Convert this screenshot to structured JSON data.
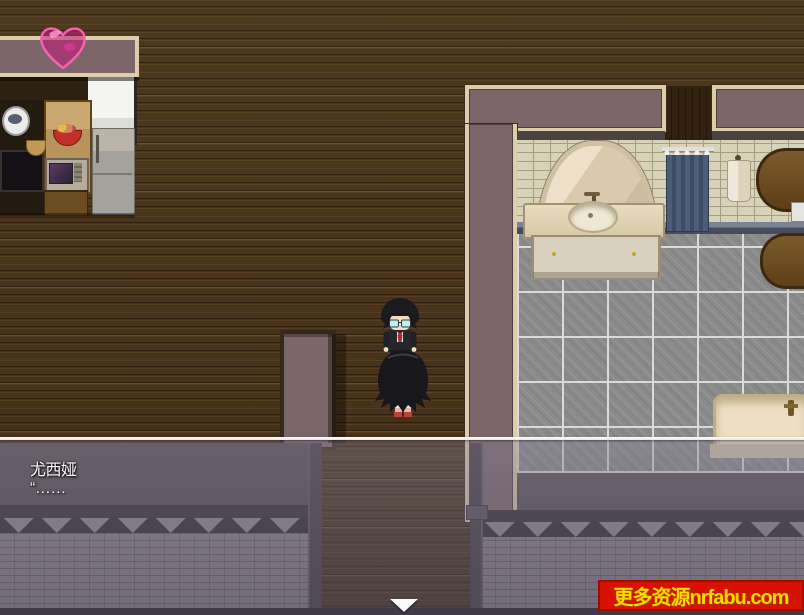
{
  "window": {
    "width": 804,
    "height": 615
  },
  "hud": {
    "heart_icon": "affection-heart-icon",
    "heart_color": "#f463b0"
  },
  "dialogue": {
    "speaker": "尤西娅",
    "line": "“……",
    "continue_icon": "down-triangle-icon"
  },
  "watermark": {
    "label": "更多资源nrfabu.com",
    "bg_color": "#d81200",
    "text_color": "#ffd800"
  },
  "scene": {
    "rooms": [
      "kitchen",
      "wood-floor-room",
      "bathroom"
    ],
    "objects": [
      "kitchen-counter",
      "microwave",
      "refrigerator",
      "window-curtain",
      "arched-mirror-alcove",
      "sink-vanity",
      "shower-curtain",
      "hanging-towel",
      "wooden-cabinet",
      "bathtub",
      "tile-floor",
      "stone-south-wall",
      "partition-pillar"
    ],
    "characters": [
      "suited-man-with-glasses",
      "long-black-haired-girl"
    ]
  },
  "palette": {
    "wood_floor": "#49321a",
    "wall_mauve": "#7c6669",
    "wall_trim": "#ddcda9",
    "bath_brick": "#d7d2b8",
    "tile_gray": "#8a8a8a",
    "curtain_blue": "#4d5d77",
    "dialog_overlay": "rgba(100,94,115,0.45)"
  }
}
